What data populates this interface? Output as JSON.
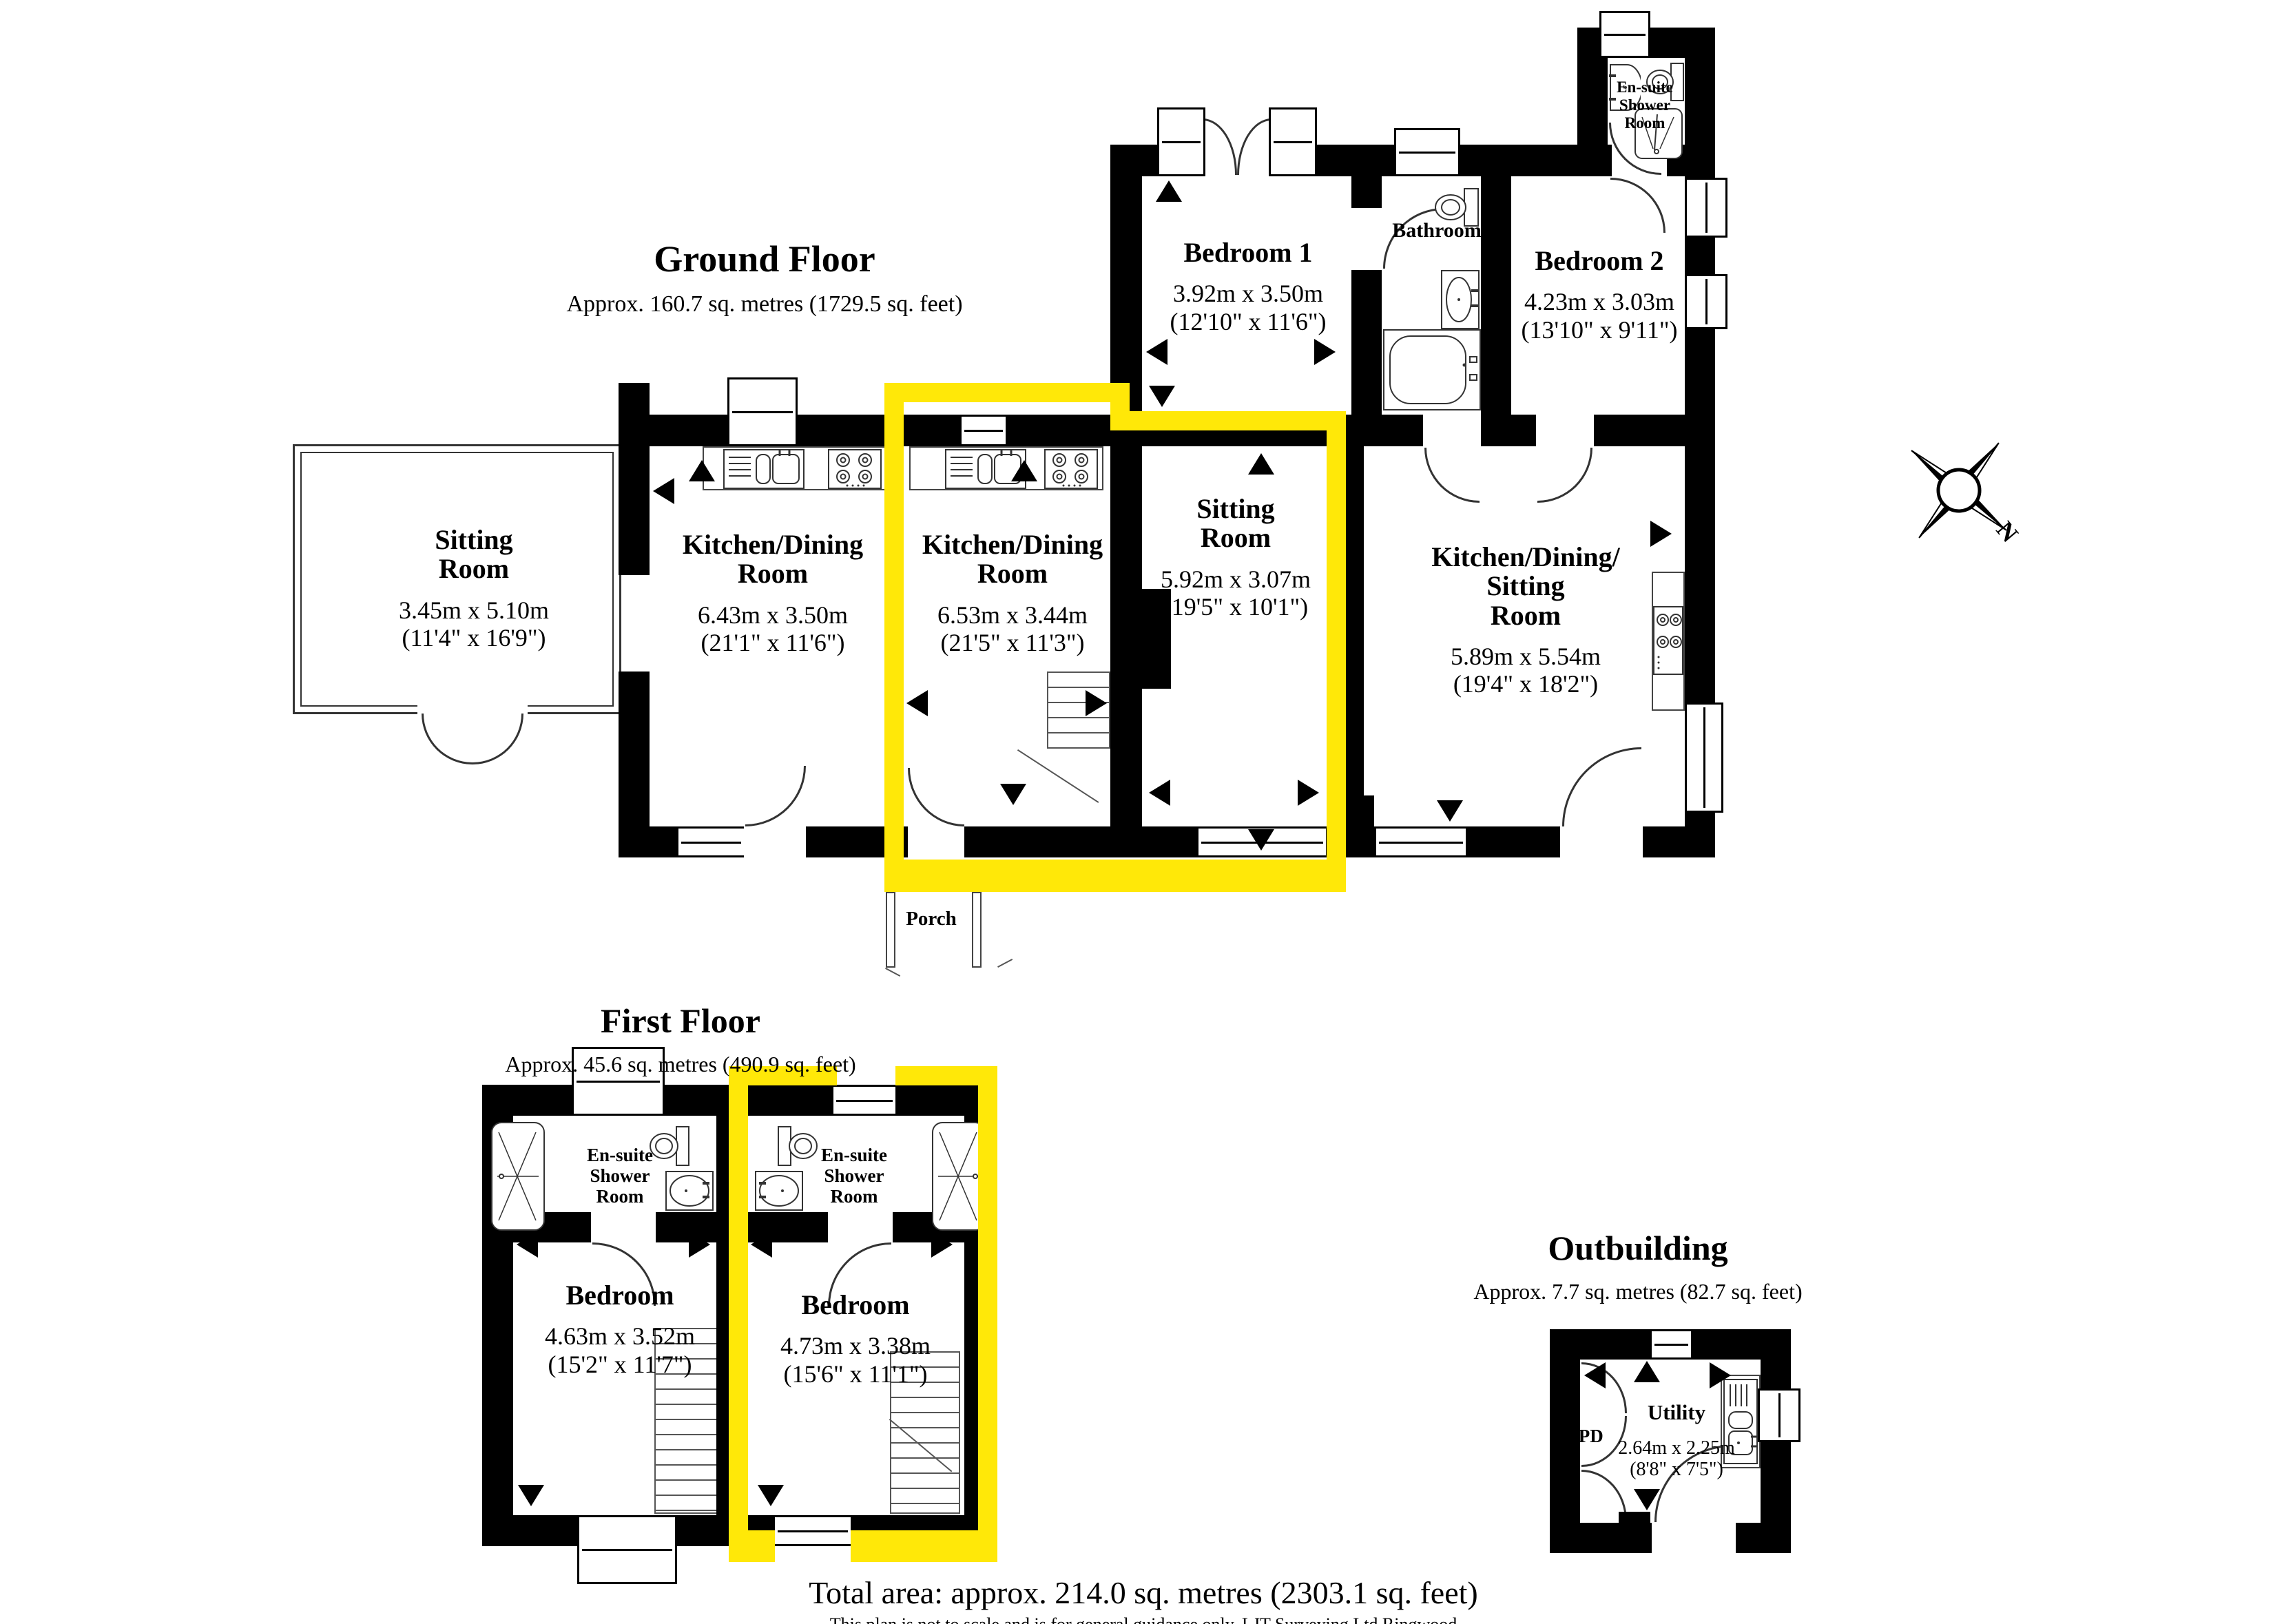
{
  "ground_floor": {
    "title": "Ground Floor",
    "subtitle": "Approx. 160.7 sq. metres (1729.5 sq. feet)",
    "rooms": {
      "sitting_room_1": {
        "name": "Sitting\nRoom",
        "dims": "3.45m x 5.10m\n(11'4\" x 16'9\")"
      },
      "kitchen_dining_1": {
        "name": "Kitchen/Dining\nRoom",
        "dims": "6.43m x 3.50m\n(21'1\" x 11'6\")"
      },
      "kitchen_dining_2": {
        "name": "Kitchen/Dining\nRoom",
        "dims": "6.53m x 3.44m\n(21'5\" x 11'3\")"
      },
      "sitting_room_2": {
        "name": "Sitting\nRoom",
        "dims": "5.92m x 3.07m\n(19'5\" x 10'1\")"
      },
      "kitchen_dining_sitting": {
        "name": "Kitchen/Dining/\nSitting\nRoom",
        "dims": "5.89m x 5.54m\n(19'4\" x 18'2\")"
      },
      "bedroom_1": {
        "name": "Bedroom 1",
        "dims": "3.92m x 3.50m\n(12'10\" x 11'6\")"
      },
      "bathroom": {
        "name": "Bathroom"
      },
      "bedroom_2": {
        "name": "Bedroom 2",
        "dims": "4.23m x 3.03m\n(13'10\" x 9'11\")"
      },
      "ensuite": {
        "name": "En-suite\nShower\nRoom"
      },
      "porch": {
        "name": "Porch"
      }
    }
  },
  "first_floor": {
    "title": "First Floor",
    "subtitle": "Approx. 45.6 sq. metres (490.9 sq. feet)",
    "rooms": {
      "bedroom_left": {
        "name": "Bedroom",
        "dims": "4.63m x 3.52m\n(15'2\" x 11'7\")"
      },
      "bedroom_right": {
        "name": "Bedroom",
        "dims": "4.73m x 3.38m\n(15'6\" x 11'1\")"
      },
      "ensuite_left": {
        "name": "En-suite\nShower\nRoom"
      },
      "ensuite_right": {
        "name": "En-suite\nShower\nRoom"
      }
    }
  },
  "outbuilding": {
    "title": "Outbuilding",
    "subtitle": "Approx. 7.7 sq. metres (82.7 sq. feet)",
    "rooms": {
      "utility": {
        "name": "Utility",
        "dims": "2.64m x 2.25m\n(8'8\" x 7'5\")"
      },
      "cpd": {
        "name": "CPD"
      }
    }
  },
  "compass": {
    "north_label": "N"
  },
  "footer": {
    "total_area": "Total area: approx. 214.0 sq. metres (2303.1 sq. feet)",
    "disclaimer": "This plan is not to scale and is for general guidance only. LJT Surveying Ltd Ringwood"
  },
  "colors": {
    "highlight_yellow": "#ffe808",
    "wall_black": "#000000"
  }
}
